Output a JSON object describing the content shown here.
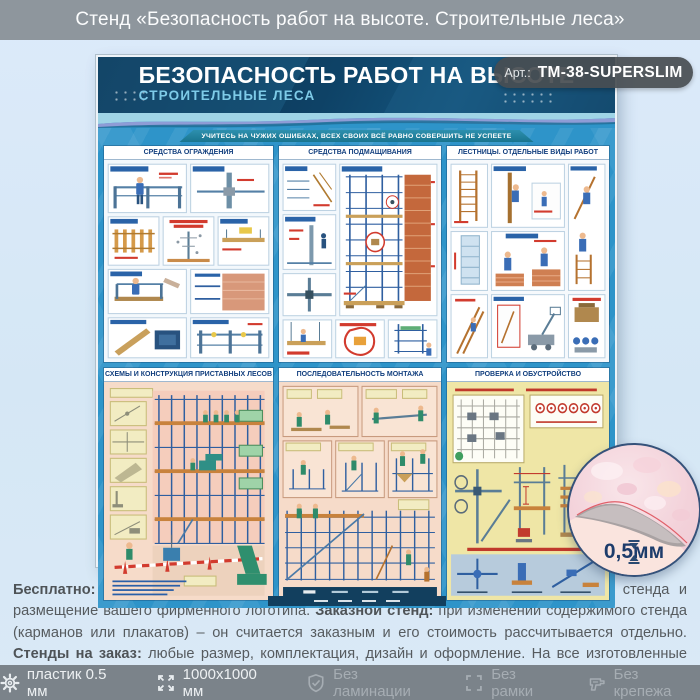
{
  "banner": {
    "title": "Стенд «Безопасность работ на высоте. Строительные леса»"
  },
  "badge": {
    "prefix": "Арт.:",
    "code": "ТМ-38-SUPERSLIM"
  },
  "poster": {
    "title": "БЕЗОПАСНОСТЬ РАБОТ НА ВЫСОТЕ",
    "subtitle": "СТРОИТЕЛЬНЫЕ ЛЕСА",
    "motto": "УЧИТЕСЬ НА ЧУЖИХ ОШИБКАХ, ВСЕХ СВОИХ ВСЁ РАВНО СОВЕРШИТЬ НЕ УСПЕЕТЕ",
    "sections": [
      {
        "title": "СРЕДСТВА ОГРАЖДЕНИЯ"
      },
      {
        "title": "СРЕДСТВА ПОДМАЩИВАНИЯ"
      },
      {
        "title": "ЛЕСТНИЦЫ. ОТДЕЛЬНЫЕ ВИДЫ РАБОТ"
      },
      {
        "title": "СХЕМЫ И КОНСТРУКЦИЯ ПРИСТАВНЫХ ЛЕСОВ"
      },
      {
        "title": "ПОСЛЕДОВАТЕЛЬНОСТЬ МОНТАЖА"
      },
      {
        "title": "ПРОВЕРКА И ОБУСТРОЙСТВО"
      }
    ]
  },
  "thickness_callout": {
    "value": "0,5мм"
  },
  "description": {
    "part1_bold": "Бесплатно:",
    "part1_text": " изменение заголовка и названий рубрик стенда, замена цвета фона стенда и размещение вашего фирменного логотипа. ",
    "part2_bold": "Заказной стенд:",
    "part2_text": " при изменении содержимого стенда (карманов или плакатов) – он считается заказным и его стоимость рассчитывается отдельно. ",
    "part3_bold": "Стенды на заказ:",
    "part3_text": " любые размер, комплектация, дизайн и оформление. На все изготовленные стенды даем 2 года гарантии. Выгодно, эстетично и надежно!"
  },
  "footer": {
    "items": [
      {
        "icon": "gear-icon",
        "label": "пластик 0.5 мм",
        "muted": false
      },
      {
        "icon": "expand-icon",
        "label": "1000x1000 мм",
        "muted": false
      },
      {
        "icon": "shield-icon",
        "label": "Без ламинации",
        "muted": true
      },
      {
        "icon": "frame-icon",
        "label": "Без рамки",
        "muted": true
      },
      {
        "icon": "drill-icon",
        "label": "Без крепежа",
        "muted": true
      }
    ]
  },
  "colors": {
    "banner_gray": "#8e969d",
    "footer_gray": "#7b838a",
    "poster_blue": "#2e94c9",
    "header_navy": "#0c3a5d",
    "background_blue": "#d7e8f5",
    "accent_red": "#d23b2e",
    "callout_text": "#1d3c6b"
  }
}
